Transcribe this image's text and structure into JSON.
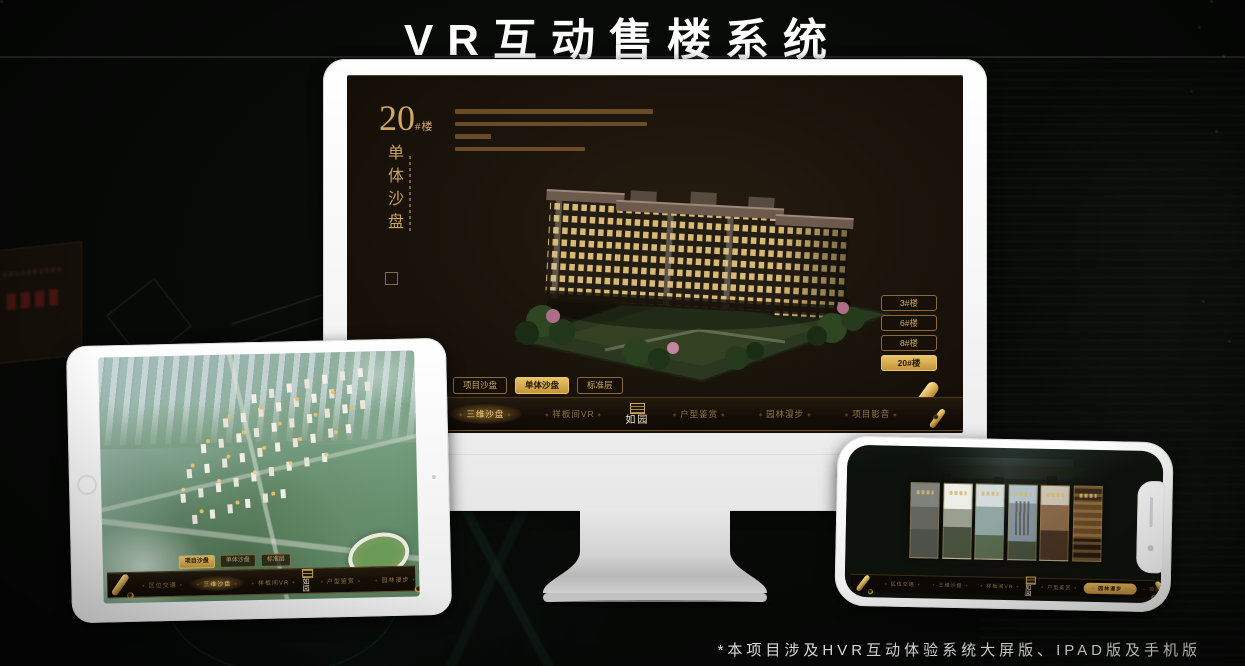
{
  "page": {
    "title": "VR互动售楼系统",
    "footnote": "*本项目涉及HVR互动体验系统大屏版、IPAD版及手机版"
  },
  "brand": {
    "logo": "如园"
  },
  "nav": {
    "items": [
      "区位交通",
      "三维沙盘",
      "样板间VR",
      "户型鉴赏",
      "园林漫步",
      "项目影音"
    ],
    "active": "三维沙盘"
  },
  "sub_tabs": {
    "items": [
      "项目沙盘",
      "单体沙盘",
      "标准层"
    ]
  },
  "monitor": {
    "active_sub_tab": "单体沙盘",
    "label": {
      "number": "20",
      "unit": "#楼",
      "subtitle": "单体沙盘"
    },
    "floor_buttons": [
      "3#楼",
      "6#楼",
      "8#楼",
      "20#楼"
    ],
    "active_floor": "20#楼"
  },
  "tablet": {
    "active_sub_tab": "项目沙盘",
    "active_nav": "三维沙盘"
  },
  "phone": {
    "active_nav": "园林漫步"
  },
  "colors": {
    "gold": "#c9a25e",
    "gold_active_bg": "#d9ad55",
    "screen_bg": "#191209"
  }
}
